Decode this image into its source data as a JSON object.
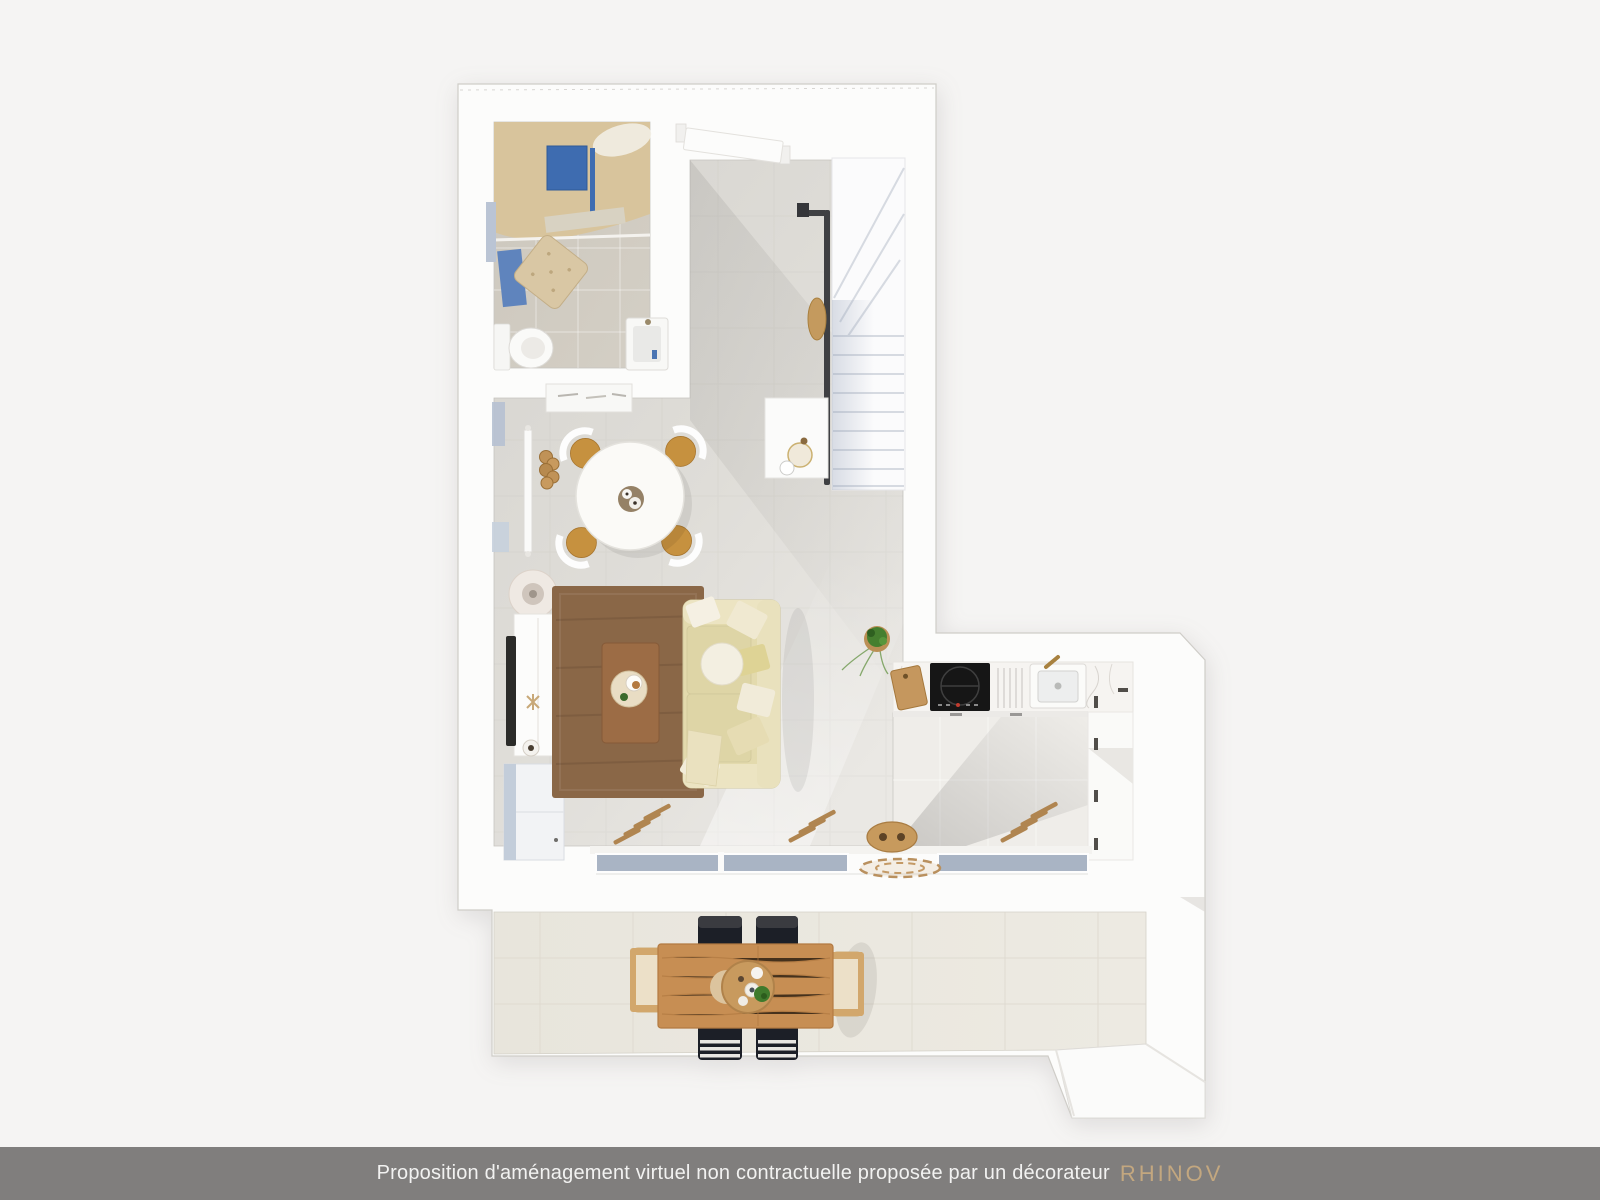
{
  "footer": {
    "disclaimer": "Proposition d'aménagement virtuel non contractuelle proposée par un décorateur",
    "brand": "RHINOV"
  },
  "colors": {
    "page_bg": "#f5f4f3",
    "footer_bg": "#807e7d",
    "footer_text": "#f2f2f1",
    "brand_gold": "#c3a77f",
    "accent_blue": "#3e6cb0",
    "glass_blue": "#a9b4c4",
    "rug_brown": "#8a6747",
    "coffee_table_wood": "#9c6c45",
    "terrace_table_wood": "#c78e53",
    "sofa_beige": "#e3daad",
    "chair_wood": "#c6913f",
    "stair_rail": "#3f4043",
    "plant_green": "#467f2f",
    "hob_black": "#161616",
    "shower_tan": "#d8c49c"
  },
  "scene": {
    "kind": "top-down 3D floor plan render",
    "rooms": [
      "bathroom",
      "hallway",
      "staircase",
      "living-dining-room",
      "kitchen",
      "terrace"
    ],
    "furniture": [
      "shower",
      "shower-panel",
      "pouf",
      "toilet",
      "washbasin",
      "bath-mat",
      "front-door",
      "staircase",
      "handrail",
      "under-stair-desk",
      "wall-console",
      "round-dining-table",
      "dining-chair",
      "log-stack",
      "radiator",
      "floor-lamp",
      "tv-sideboard",
      "tv",
      "media-cabinet",
      "rug",
      "coffee-table",
      "sofa",
      "potted-plant",
      "cutting-board",
      "induction-hob",
      "kitchen-sink",
      "tall-cabinets",
      "sliding-bay-window",
      "doormat",
      "bench",
      "jute-rug",
      "outdoor-dining-table",
      "outdoor-chair-black",
      "outdoor-chair-striped",
      "outdoor-chair-wood",
      "centerpiece-tray"
    ]
  }
}
